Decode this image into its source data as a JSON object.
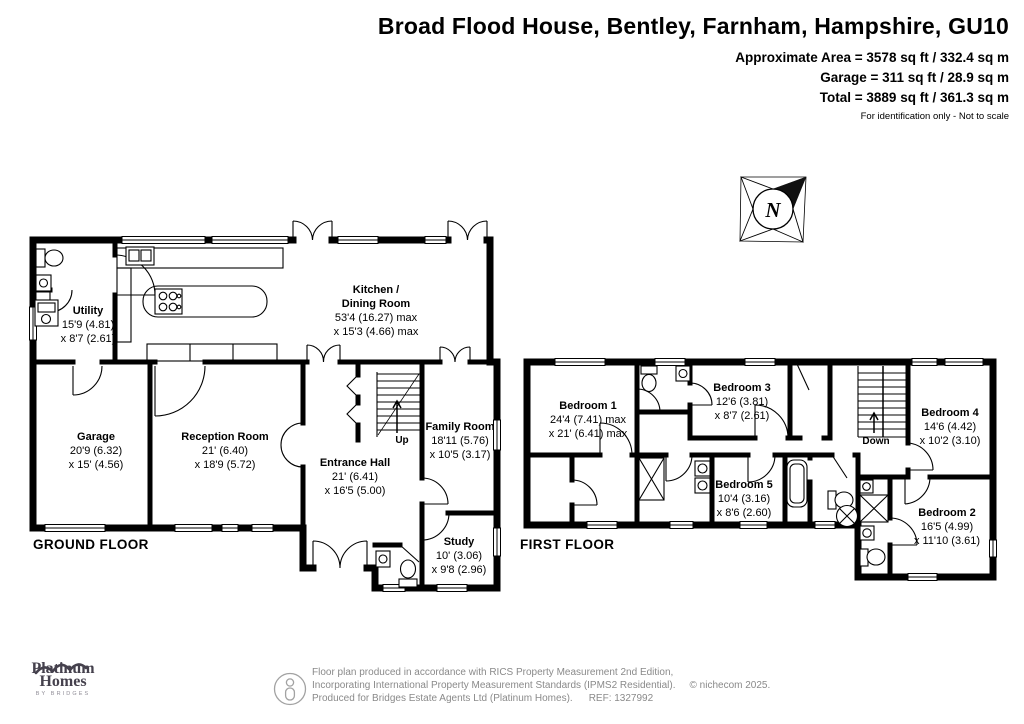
{
  "header": {
    "title": "Broad Flood House, Bentley, Farnham, Hampshire, GU10",
    "approx_area": "Approximate Area = 3578 sq ft / 332.4 sq m",
    "garage_area": "Garage = 311 sq ft / 28.9 sq m",
    "total_area": "Total = 3889 sq ft / 361.3 sq m",
    "disclaimer": "For identification only - Not to scale"
  },
  "compass": {
    "north_label": "N"
  },
  "ground_floor": {
    "label": "GROUND FLOOR",
    "stairs_label": "Up",
    "rooms": {
      "utility": {
        "name": "Utility",
        "dim1": "15'9 (4.81)",
        "dim2": "x 8'7 (2.61)"
      },
      "kitchen": {
        "name1": "Kitchen /",
        "name2": "Dining Room",
        "dim1": "53'4 (16.27) max",
        "dim2": "x 15'3 (4.66) max"
      },
      "garage": {
        "name": "Garage",
        "dim1": "20'9 (6.32)",
        "dim2": "x 15' (4.56)"
      },
      "reception": {
        "name": "Reception Room",
        "dim1": "21' (6.40)",
        "dim2": "x 18'9 (5.72)"
      },
      "entrance": {
        "name": "Entrance Hall",
        "dim1": "21' (6.41)",
        "dim2": "x 16'5 (5.00)"
      },
      "family": {
        "name": "Family Room",
        "dim1": "18'11 (5.76)",
        "dim2": "x 10'5 (3.17)"
      },
      "study": {
        "name": "Study",
        "dim1": "10' (3.06)",
        "dim2": "x 9'8 (2.96)"
      }
    }
  },
  "first_floor": {
    "label": "FIRST FLOOR",
    "stairs_label": "Down",
    "rooms": {
      "bedroom1": {
        "name": "Bedroom 1",
        "dim1": "24'4 (7.41) max",
        "dim2": "x 21' (6.41) max"
      },
      "bedroom3": {
        "name": "Bedroom 3",
        "dim1": "12'6 (3.81)",
        "dim2": "x 8'7 (2.61)"
      },
      "bedroom4": {
        "name": "Bedroom 4",
        "dim1": "14'6 (4.42)",
        "dim2": "x 10'2 (3.10)"
      },
      "bedroom5": {
        "name": "Bedroom 5",
        "dim1": "10'4 (3.16)",
        "dim2": "x 8'6 (2.60)"
      },
      "bedroom2": {
        "name": "Bedroom 2",
        "dim1": "16'5 (4.99)",
        "dim2": "x 11'10 (3.61)"
      }
    }
  },
  "footer": {
    "logo_line1": "Platinum",
    "logo_line2": "Homes",
    "logo_sub": "BY BRIDGES",
    "line1": "Floor plan produced in accordance with RICS Property Measurement 2nd Edition,",
    "line2": "Incorporating International Property Measurement Standards (IPMS2 Residential).",
    "copyright": "© nichecom 2025.",
    "line3": "Produced for Bridges Estate Agents Ltd (Platinum Homes).",
    "ref": "REF: 1327992"
  },
  "colors": {
    "wall": "#000000",
    "footer_text": "#8a8a8a",
    "logo": "#45414d"
  }
}
